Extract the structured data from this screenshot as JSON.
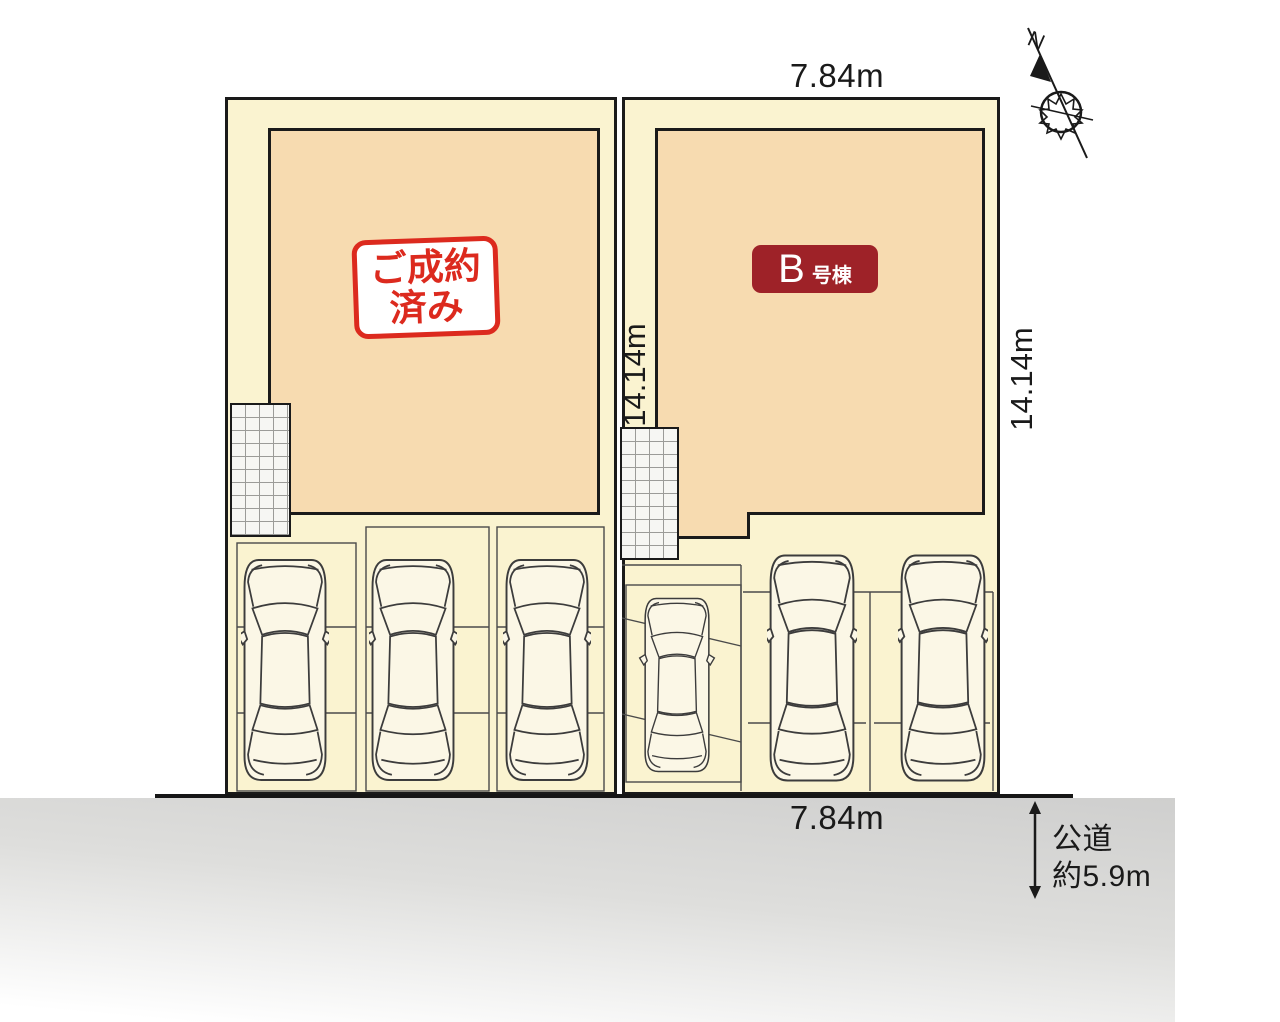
{
  "compass": {
    "north_label": "N"
  },
  "dimensions": {
    "top_width": "7.84m",
    "bottom_width": "7.84m",
    "inner_depth": "14.14m",
    "outer_depth": "14.14m"
  },
  "road": {
    "name": "公道",
    "width": "約5.9m"
  },
  "lots": {
    "sold": {
      "stamp_line1": "ご成約",
      "stamp_line2": "済み",
      "parking_spaces": 3
    },
    "b": {
      "unit_letter": "B",
      "unit_suffix": "号棟",
      "parking_spaces": 3
    }
  },
  "colors": {
    "lot_fill": "#FAF3D0",
    "building_fill": "#F7DBB0",
    "sold_red": "#DC2A1E",
    "unit_badge": "#9E2228",
    "road_gray": "#D1D1D0",
    "line": "#1A1A1A"
  }
}
